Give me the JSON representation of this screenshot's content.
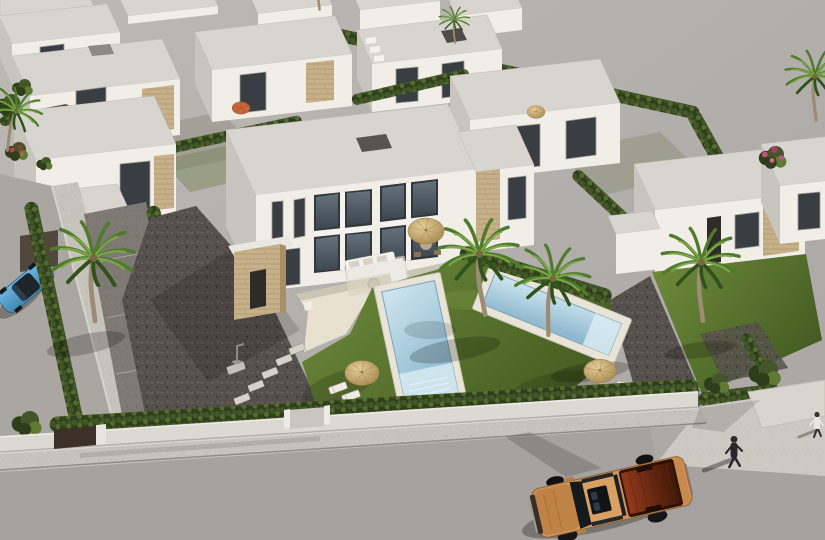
{
  "scene": {
    "title": "Aerial 3D architectural rendering of a new-build villa development",
    "description": "High-angle render of rows of white flat-roofed villas with travertine stone accents, private rectangular pools with light-blue water, bright lawns, fan palms, clipped cypress hedges, dark gravel yards with stepping-stone paths, straw parasols with sun loungers, a low white perimeter wall with a dark gate along a wide grey street, a sand-orange double-cab pickup truck driving past, a light-blue car parked on the side street and two pedestrians on the pavement near the corner plot.",
    "time_of_day": "bright daylight",
    "objects": [
      {
        "name": "main-villa",
        "desc": "two-storey white villa with full-height glazing, stone entrance pillar and roof hatch"
      },
      {
        "name": "pool-main",
        "desc": "rectangular pool with light-blue water and pale stone deck"
      },
      {
        "name": "pool-neighbor",
        "desc": "second rectangular pool on the adjoining plot"
      },
      {
        "name": "terrace",
        "desc": "cream terrace with white lounge sofa and dining set under a straw parasol"
      },
      {
        "name": "palm-trees",
        "desc": "fan palms dotted around the gardens and street"
      },
      {
        "name": "hedges",
        "desc": "clipped dark-green hedges dividing the plots"
      },
      {
        "name": "lawns",
        "desc": "bright green turf surrounding the pools"
      },
      {
        "name": "gravel-yards",
        "desc": "dark decorative gravel with stepping-stone paths and outdoor shower"
      },
      {
        "name": "straw-parasols",
        "desc": "round straw parasols with pairs of sun loungers"
      },
      {
        "name": "orange-parasol",
        "desc": "small orange parasol on a rear patio"
      },
      {
        "name": "perimeter-wall",
        "desc": "low white wall with dark entrance gate along the street"
      },
      {
        "name": "street",
        "desc": "wide light-grey asphalt road with pavement, corner apron and driveway ramp"
      },
      {
        "name": "pickup-truck",
        "desc": "sand-orange double-cab pickup with open dark-red load bed"
      },
      {
        "name": "blue-car",
        "desc": "light-blue car parked on the side street"
      },
      {
        "name": "pedestrian-dark",
        "desc": "person in dark clothes walking on the pavement casting a long shadow"
      },
      {
        "name": "pedestrian-light",
        "desc": "person in a white shirt near the corner plot"
      },
      {
        "name": "background-villas",
        "desc": "rows of identical white villas with stone panels behind the main plot"
      },
      {
        "name": "empty-plot",
        "desc": "flat grey unbuilt ground behind and beside the development"
      },
      {
        "name": "bougainvillea",
        "desc": "pink flowering shrubs on the right boundary, red shrubs at left"
      }
    ]
  },
  "palette": {
    "bg-top": "#bdb9b5",
    "bg-bot": "#a9a6a4",
    "road": "#a6a29f",
    "road-edge": "#908c88",
    "sidewalk": "#c6c2bc",
    "apron": "#ccc8c2",
    "ramp": "#d9d5ce",
    "wall": "#dcd9d3",
    "wall-shade": "#b3afa9",
    "gate": "#3b3128",
    "roof-top": "#d8d5d0",
    "roof-light": "#e9e7e2",
    "face-sun": "#f1eee8",
    "face-shade": "#c8c4be",
    "window": "#383e42",
    "glass-hi": "#64727c",
    "glass-lo": "#3c464e",
    "frame": "#a09e99",
    "stone": "#c7b18b",
    "stone-dark": "#ad9368",
    "gravel": "#55504b",
    "hedge": "#43562a",
    "hedge-dark": "#2e3d1a",
    "hedge-light": "#5f7a33",
    "lawn-light": "#6f8c3c",
    "lawn-dark": "#445c22",
    "palm-green": "#4e7c2c",
    "palm-light": "#7da844",
    "palm-dark": "#2f521a",
    "palm-trunk": "#9c8c75",
    "pool-deck": "#e9e4d8",
    "pool-light": "#cfe6f0",
    "pool-mid": "#8fb9cf",
    "terrace": "#e9e1cf",
    "parasol": "#cfb37e",
    "parasol-dark": "#a08147",
    "parasol-orange": "#c9693a",
    "sofa": "#f3f1ec",
    "truck-body": "#d0945a",
    "truck-hood": "#c08347",
    "truck-dark": "#8f6233",
    "bed-hi": "#93391b",
    "bed-lo": "#3f1808",
    "car-hi": "#6ab5e2",
    "car-lo": "#3e85ad",
    "fig-dark": "#26272b",
    "fig-light": "#eae8e4"
  }
}
